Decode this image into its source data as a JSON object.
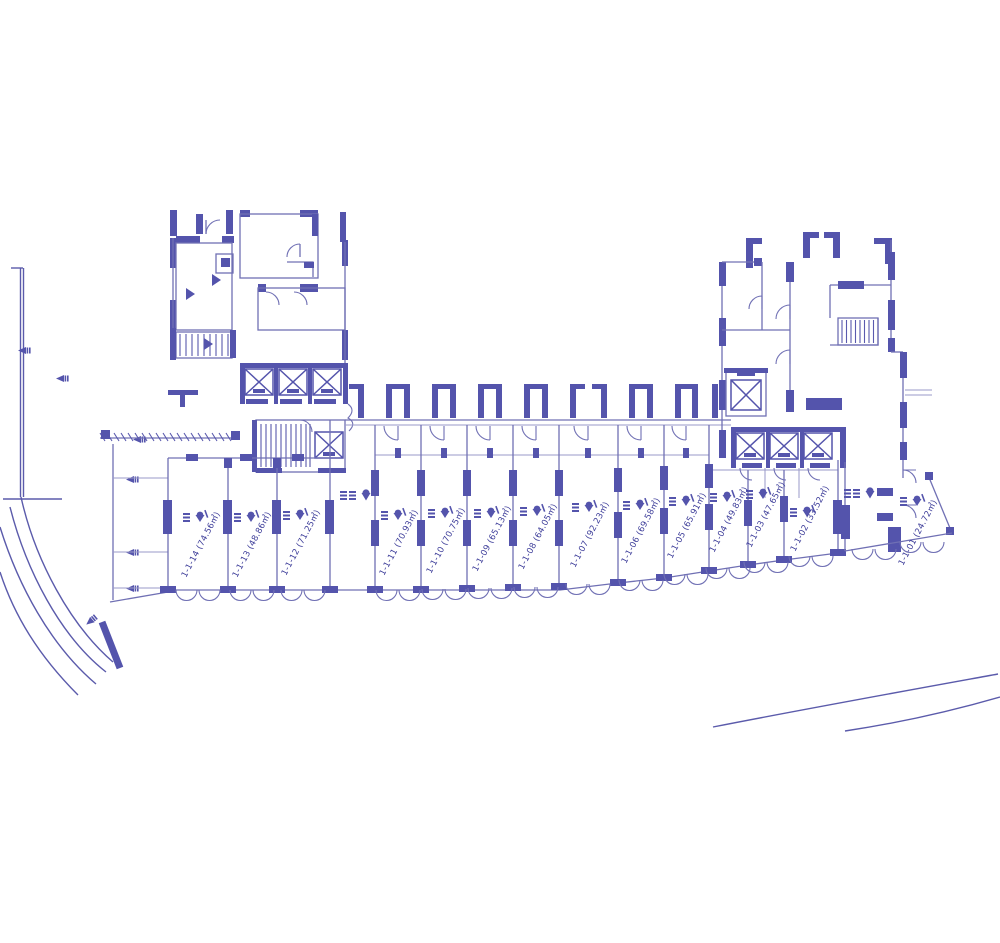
{
  "drawing": {
    "type": "architectural floor plan - ground floor retail units",
    "background": "#ffffff",
    "ink_color": "#5454ac",
    "thin_line_color": "#7070b4",
    "label_color": "#3e3e9a",
    "area_unit": "㎡"
  },
  "units": [
    {
      "id": "1-1-14",
      "area": "74.56",
      "label": "1-1-14 (74.56㎡)"
    },
    {
      "id": "1-1-13",
      "area": "48.86",
      "label": "1-1-13 (48.86㎡)"
    },
    {
      "id": "1-1-12",
      "area": "71.25",
      "label": "1-1-12 (71.25㎡)"
    },
    {
      "id": "1-1-11",
      "area": "70.93",
      "label": "1-1-11 (70.93㎡)"
    },
    {
      "id": "1-1-10",
      "area": "70.75",
      "label": "1-1-10 (70.75㎡)"
    },
    {
      "id": "1-1-09",
      "area": "65.13",
      "label": "1-1-09 (65.13㎡)"
    },
    {
      "id": "1-1-08",
      "area": "64.05",
      "label": "1-1-08 (64.05㎡)"
    },
    {
      "id": "1-1-07",
      "area": "92.23",
      "label": "1-1-07 (92.23㎡)"
    },
    {
      "id": "1-1-06",
      "area": "69.58",
      "label": "1-1-06 (69.58㎡)"
    },
    {
      "id": "1-1-05",
      "area": "65.91",
      "label": "1-1-05 (65.91㎡)"
    },
    {
      "id": "1-1-04",
      "area": "49.83",
      "label": "1-1-04 (49.83㎡)"
    },
    {
      "id": "1-1-03",
      "area": "47.65",
      "label": "1-1-03 (47.65㎡)"
    },
    {
      "id": "1-1-02",
      "area": "33.52",
      "label": "1-1-02 (33.52㎡)"
    },
    {
      "id": "1-1-01",
      "area": "24.72",
      "label": "1-1-01 (24.72㎡)"
    }
  ],
  "symbols": [
    "elevator-shaft-icon",
    "staircase-hatch-icon",
    "door-swing-arc-icon",
    "elevation-marker-icon",
    "site-boundary-line",
    "road-edge-line"
  ]
}
